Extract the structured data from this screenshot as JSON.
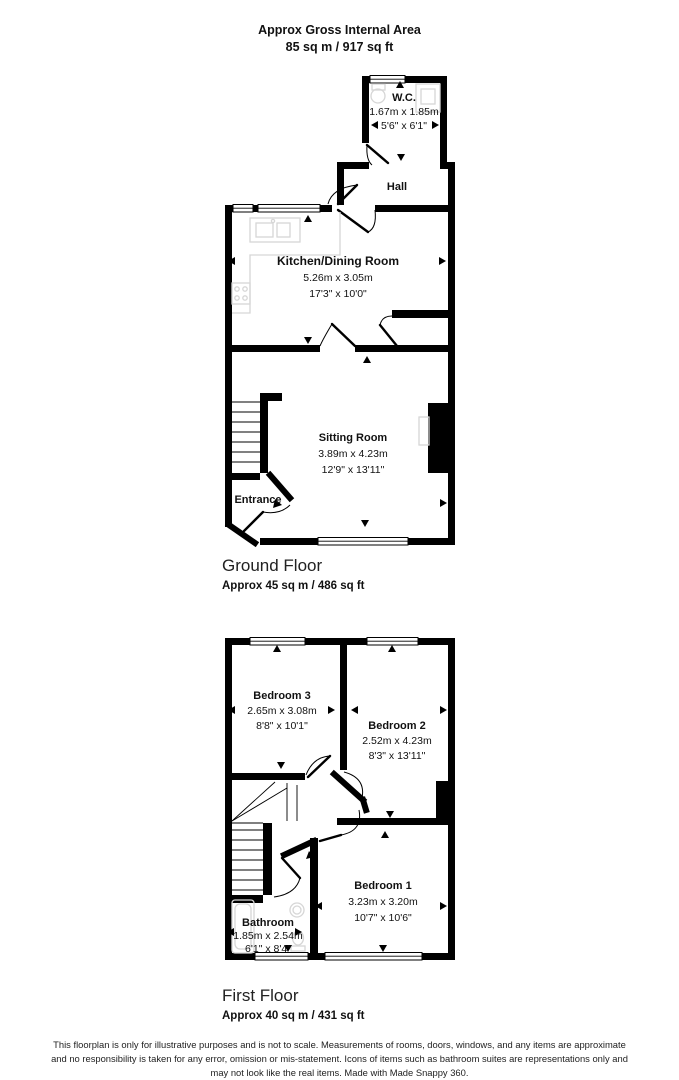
{
  "header": {
    "line1": "Approx Gross Internal Area",
    "line2": "85 sq m / 917 sq ft"
  },
  "ground_floor": {
    "label": "Ground Floor",
    "area": "Approx 45 sq m / 486 sq ft",
    "rooms": [
      {
        "name": "W.C.",
        "metric": "1.67m x 1.85m",
        "imperial": "5'6\" x 6'1\""
      },
      {
        "name": "Hall"
      },
      {
        "name": "Kitchen/Dining Room",
        "metric": "5.26m x 3.05m",
        "imperial": "17'3\" x 10'0\""
      },
      {
        "name": "Sitting Room",
        "metric": "3.89m x 4.23m",
        "imperial": "12'9\" x 13'11\""
      },
      {
        "name": "Entrance"
      }
    ]
  },
  "first_floor": {
    "label": "First Floor",
    "area": "Approx 40 sq m / 431 sq ft",
    "rooms": [
      {
        "name": "Bedroom 3",
        "metric": "2.65m x 3.08m",
        "imperial": "8'8\" x 10'1\""
      },
      {
        "name": "Bedroom 2",
        "metric": "2.52m x 4.23m",
        "imperial": "8'3\" x 13'11\""
      },
      {
        "name": "Bedroom 1",
        "metric": "3.23m x 3.20m",
        "imperial": "10'7\" x 10'6\""
      },
      {
        "name": "Bathroom",
        "metric": "1.85m x 2.54m",
        "imperial": "6'1\" x 8'4\""
      }
    ]
  },
  "disclaimer": "This floorplan is only for illustrative purposes and is not to scale. Measurements of rooms, doors, windows, and any items are approximate and no responsibility is taken for any error, omission or mis-statement. Icons of items such as bathroom suites are representations only and may not look like the real items. Made with Made Snappy 360.",
  "colors": {
    "wall": "#000000",
    "fixture": "#d6d6d6",
    "text": "#1a1a1a"
  }
}
